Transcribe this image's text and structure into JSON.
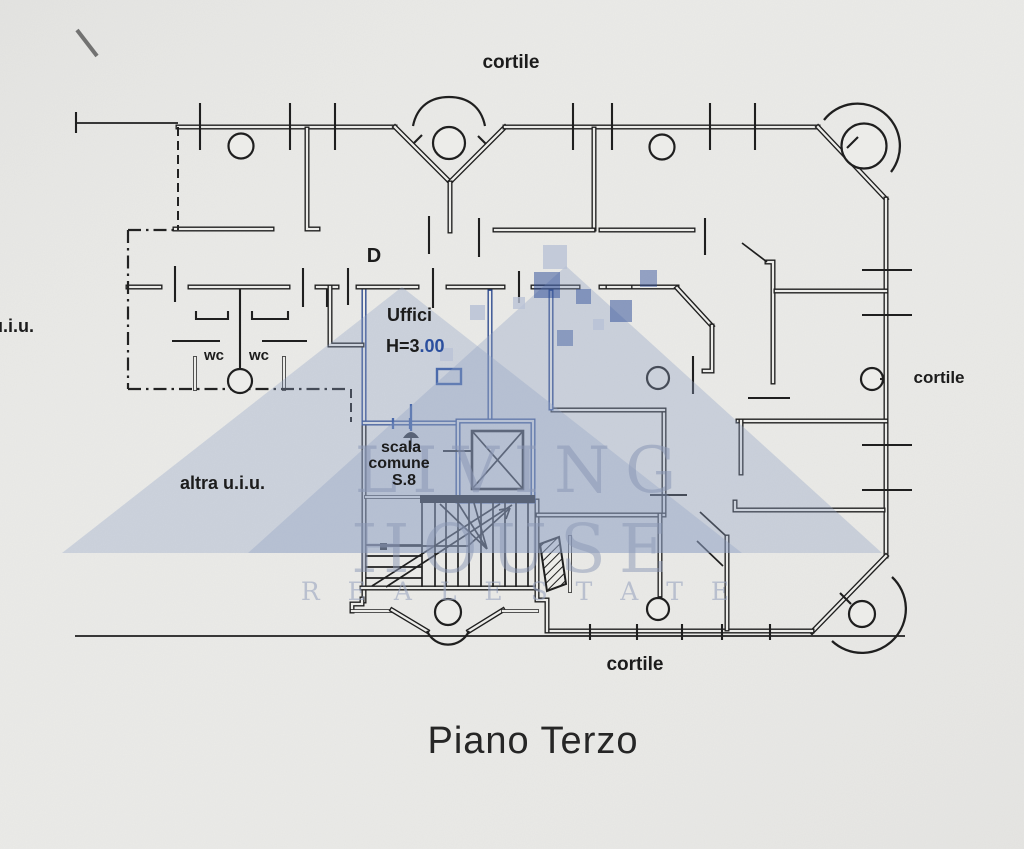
{
  "document": {
    "kind": "scanned floor plan",
    "floor_title": "Piano Terzo"
  },
  "labels": {
    "courtyard_top": "cortile",
    "courtyard_right": "cortile",
    "courtyard_bottom": "cortile",
    "unit_left_partial": "u.i.u.",
    "adjacent_unit": "altra u.i.u.",
    "wc_left": "wc",
    "wc_right": "wc",
    "room_d": "D",
    "office": "Uffici",
    "office_height_prefix": "H=3",
    "office_height_suffix": ".00",
    "stairs_line1": "scala",
    "stairs_line2": "comune",
    "stairs_line3": "S.8"
  },
  "watermark": {
    "logo": "house-roof-logo",
    "brand_line1": "LIVING",
    "brand_line2": "HOUSE",
    "brand_line3": "R E A L    E S T A T E",
    "roof_color": "#8ea0c4",
    "accent_color": "#2a4a96"
  },
  "colors": {
    "paper": "#ebebe8",
    "ink": "#1f1f1f",
    "highlight_blue": "#2b4f9e"
  }
}
